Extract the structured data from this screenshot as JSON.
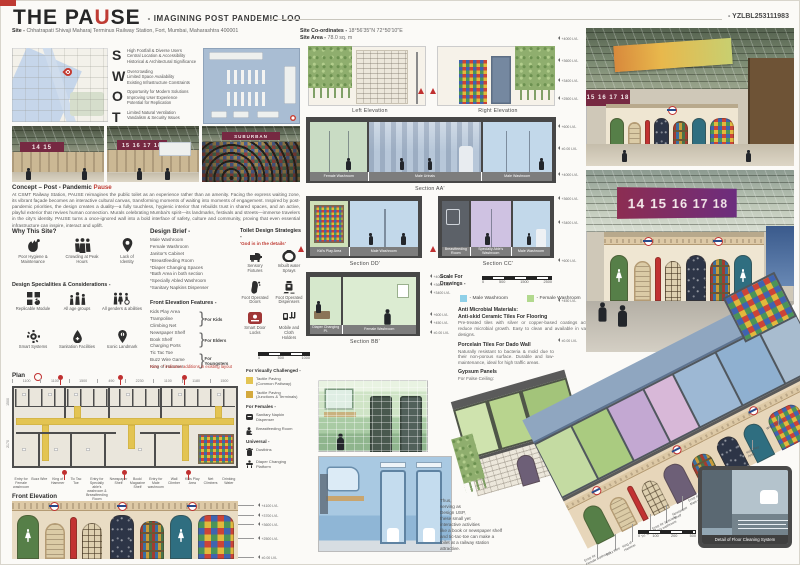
{
  "header": {
    "title_pre": "THE PA",
    "title_accent": "U",
    "title_post": "SE",
    "subtitle": "- IMAGINING POST PANDEMIC LOO",
    "code": "- YZLBL253111983"
  },
  "site": {
    "site_label": "Site -",
    "site_value": "Chhatrapati Shivaji Maharaj Terminus Railway Station, Fort, Mumbai, Maharashtra 400001",
    "coords_label": "Site Co-ordinates -",
    "coords_value": "18°56'35\"N 72°50'10\"E",
    "area_label": "Site Area -",
    "area_value": "78.0 sq. m"
  },
  "swot": {
    "items": [
      {
        "letter": "S",
        "text": "High Footfall & Diverse Users\nCentral Location & Accessibility\nHistorical & Architectural Significance"
      },
      {
        "letter": "W",
        "text": "Overcrowding\nLimited Space Availability\nExisting Infrastructure Constraints"
      },
      {
        "letter": "O",
        "text": "Opportunity for Modern Solutions\nImproving User Experience\nPotential for Replication"
      },
      {
        "letter": "T",
        "text": "Limited Natural Ventilation\nVandalism & Security Issues"
      }
    ]
  },
  "photos": {
    "sign1": "15 16 17 18",
    "sign2": "14 15 16 17 18"
  },
  "concept": {
    "heading_pre": "Concept – Post - Pandemic ",
    "heading_accent": "Pause",
    "body": "At CSMT Railway Station, PAUSE reimagines the public toilet as an experience rather than an amenity. Facing the express waiting zone, its vibrant façade becomes an interactive cultural canvas, transforming moments of waiting into moments of engagement. Inspired by post-pandemic priorities, the design creates a duality—a fully touchless, hygienic interior that rebuilds trust in shared spaces, and an active, playful exterior that revives human connection. Murals celebrating Mumbai's spirit—its landmarks, festivals and streets—immerse travelers in the city's identity. PAUSE turns a once-ignored wall into a bold interface of safety, culture and community, proving that even essential infrastructure can inspire, interact and uplift."
  },
  "why_site": {
    "heading": "Why This Site?",
    "items": [
      {
        "label": "Poor Hygiene &\nMaintenance"
      },
      {
        "label": "Crowding at Peak\nHours"
      },
      {
        "label": "Lack of\nIdentity"
      }
    ]
  },
  "brief": {
    "heading": "Design Brief -",
    "list": "Male Washroom\nFemale Washroom\nJanitor's Cabinet\n*Breastfeeding Room\n*Diaper Changing Spaces\n*Bath Area in both section\n*Specially Abled Washroom\n*Sanitary Napkins Dispenser"
  },
  "strategies": {
    "heading": "Toilet Design Strategies -",
    "sub": "'God is in the details'",
    "items": [
      {
        "label": "Sensory Fixtures"
      },
      {
        "label": "Inbuilt water Sprays"
      },
      {
        "label": "Foot Operated\nDoors"
      },
      {
        "label": "Foot Operated\nDispensers"
      },
      {
        "label": "Smart Door Locks"
      },
      {
        "label": "Mobile and Cloth\nHolders"
      }
    ]
  },
  "specialities": {
    "heading": "Design Specialities & Considerations -",
    "items": [
      {
        "label": "Replicable Module"
      },
      {
        "label": "All age groups"
      },
      {
        "label": "All genders & abilities"
      },
      {
        "label": "Smart Systems"
      },
      {
        "label": "Sanitation Facilities"
      },
      {
        "label": "Iconic Landmark"
      }
    ]
  },
  "features": {
    "heading": "Front Elevation Features -",
    "list": "Kids Play Area\nTrampoline\nClimbing Net\nNewspaper Shelf\nBook Shelf\nCharging Ports\nTic Tac Toe\nBuzz Wire Game\nKing of Hammer",
    "groups": [
      "For Kids",
      "For Elders",
      "For Youngsters"
    ],
    "note": "Note - * indicates additions in existing layout"
  },
  "plan": {
    "heading": "Plan",
    "dims_top": [
      "1100",
      "1100",
      "1500",
      "490",
      "2230",
      "1100",
      "1180",
      "1500"
    ],
    "dims_left": [
      "1500",
      "2170"
    ],
    "labels": [
      "Entry for\nFemale washroom",
      "Buzz Wire",
      "King of\nHammer",
      "Tic Tac Toe",
      "Entry for Specially\nable's washroom &\nBreastfeeding Room",
      "Newspaper\nShelf",
      "Book/\nMagazine\nShelf",
      "Entry for\nMale washroom",
      "Wall\nClimber",
      "Kids Play\nArea",
      "Net\nClimbers",
      "Drinking\nWater"
    ]
  },
  "plan_legend": {
    "scale_marks": [
      "0",
      "500",
      "1000"
    ],
    "vis_heading": "For Visually Challenged -",
    "vis_items": [
      {
        "label": "Tactile Paving\n(Common Pathway)"
      },
      {
        "label": "Tactile Paving\n(Junctions & Terminals)"
      }
    ],
    "fem_heading": "For Females -",
    "fem_items": [
      {
        "label": "Sanitary Napkin\nDispenser"
      },
      {
        "label": "Breastfeeding Room"
      }
    ],
    "uni_heading": "Universal -",
    "uni_items": [
      {
        "label": "Dustbins"
      },
      {
        "label": "Diaper Changing\nPlatform"
      }
    ]
  },
  "front_elev": {
    "heading": "Front Elevation",
    "levels": [
      "+4100 LVL",
      "+3700 LVL",
      "+3600 LVL",
      "+2500 LVL",
      "±0.00 LVL"
    ]
  },
  "elevations": {
    "left_caption": "Left Elevation",
    "right_caption": "Right Elevation"
  },
  "sections": {
    "aa": {
      "caption": "Section AA'",
      "rooms": [
        "Female Washroom",
        "Male Urinals",
        "Male Washroom"
      ]
    },
    "dd": {
      "caption": "Section DD'",
      "rooms": [
        "Kid's Play Area",
        "Male Washroom"
      ]
    },
    "cc": {
      "caption": "Section CC'",
      "rooms": [
        "Breastfeeding Room",
        "Specially Able's Washroom",
        "Male Washroom"
      ]
    },
    "bb": {
      "caption": "Section BB'",
      "rooms": [
        "Diaper Changing Pl.",
        "Female Washroom"
      ]
    }
  },
  "levels_col": {
    "items": [
      "+4000 LVL",
      "+3600 LVL",
      "+3400 LVL",
      "+2500 LVL",
      "+600 LVL",
      "±0.00 LVL",
      "+4000 LVL",
      "+3600 LVL",
      "+3400 LVL",
      "+600 LVL",
      "+450 LVL",
      "±0.00 LVL"
    ]
  },
  "bb_levels": {
    "items": [
      "+4000 LVL",
      "+3600 LVL",
      "+3400 LVL",
      "+600 LVL",
      "+450 LVL",
      "±0.00 LVL"
    ]
  },
  "scale_drawings": {
    "label": "Scale For\nDrawings -",
    "marks": [
      "0",
      "500",
      "1500",
      "2500"
    ]
  },
  "wash_legend": {
    "items": [
      {
        "label": "- Male Washroom",
        "color": "#8fd0e8"
      },
      {
        "label": "- Female Washroom",
        "color": "#b2d98e"
      },
      {
        "label": "- Unisex Washroom",
        "color": "#e8a8c8"
      }
    ]
  },
  "materials": {
    "m1_title": "Anti Microbial Materials:",
    "m1_sub": "Anti-skid Ceramic Tiles For Flooring",
    "m1_body": "Pre-treated tiles with silver or copper-based coatings actively reduce microbial growth. Easy to clean and available in various designs.",
    "m2_title": "Porcelain Tiles For Dado Wall",
    "m2_body": "Naturally resistant to bacteria & mold due to their non-porous surface. Durable and low-maintenance, ideal for high traffic areas.",
    "m3_title": "Gypsum Panels",
    "m3_body": "For False Ceiling:"
  },
  "usp": {
    "text": "Thus,\nserving as\nDesign USP,\nthese small yet\ninteractive activities\nlike a book or newspaper shelf and tic-tac-toe can make a toilet at a railway station attractive."
  },
  "roundel": {
    "text": "THE PAUSE"
  },
  "axon": {
    "callouts": [
      "Entry for\nFemale washroom",
      "Buzz Wire",
      "King of\nHammer",
      "Tic Tac Toe",
      "Entry for Specially\nable's washroom",
      "Newspaper\nShelf",
      "Entry for\nMale washroom",
      "Kids Play\nArea",
      "Wall Climbers"
    ],
    "scale_marks": [
      "0",
      "100",
      "200",
      "500"
    ],
    "inset_caption": "Detail of Floor Cleaning System"
  }
}
